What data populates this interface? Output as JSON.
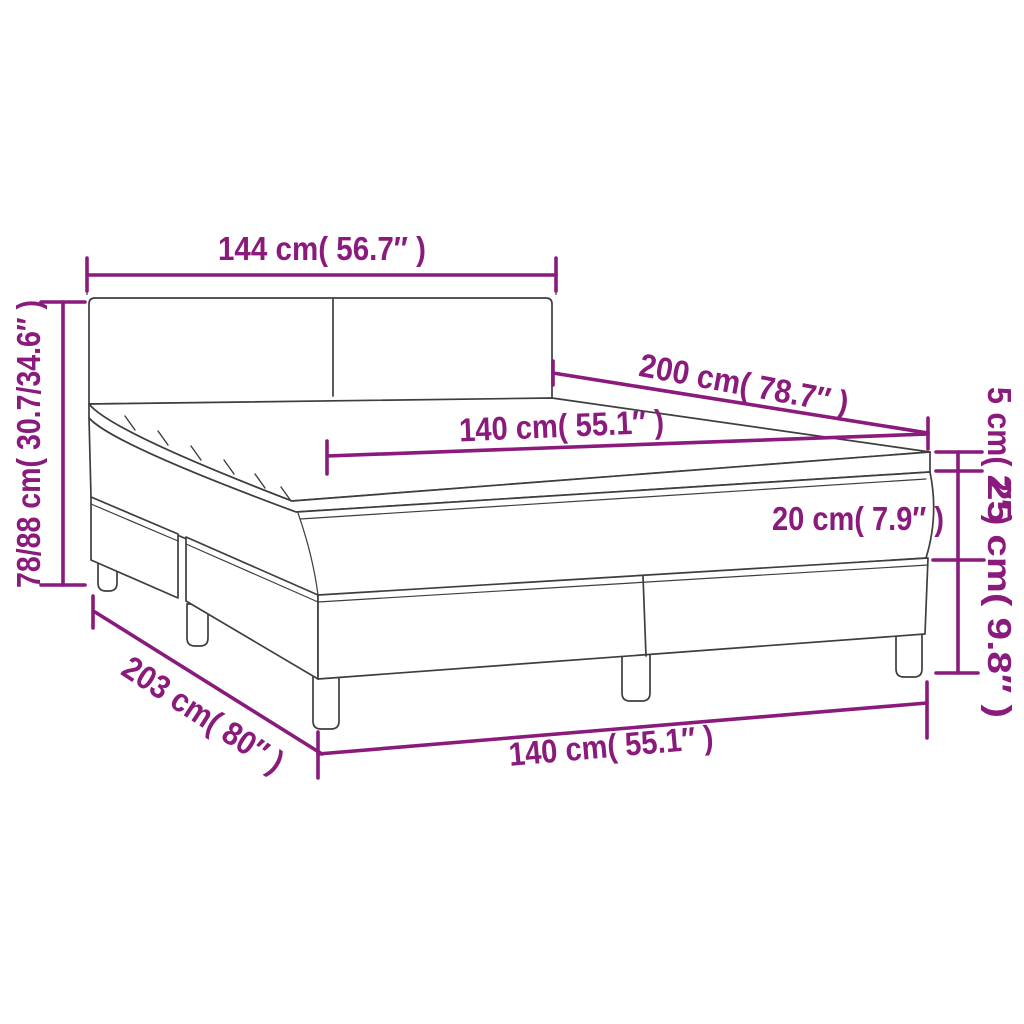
{
  "diagram": {
    "labels": {
      "headboard_width": "144 cm( 56.7″ )",
      "total_height": "78/88 cm( 30.7/34.6″ )",
      "mattress_length": "200 cm( 78.7″ )",
      "mattress_width_top": "140 cm( 55.1″ )",
      "topper_height": "5 cm( 2″ )",
      "mattress_height": "20 cm( 7.9″ )",
      "base_height": "25 cm( 9.8″ )",
      "bed_length": "203 cm( 80″ )",
      "mattress_width_bottom": "140 cm( 55.1″ )"
    },
    "colors": {
      "dimension": "#8a1a7c",
      "outline": "#3e3e3d",
      "background": "#ffffff"
    }
  }
}
